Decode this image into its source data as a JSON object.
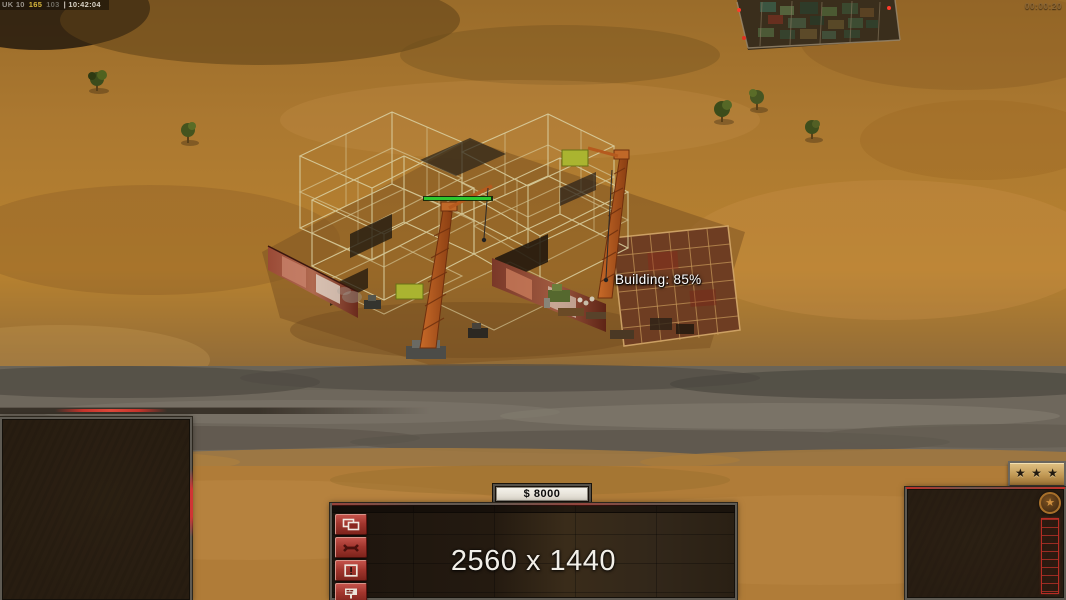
{
  "hud": {
    "debug_overlay": {
      "segments": [
        {
          "text": "UK 10",
          "color": "#9a948c"
        },
        {
          "text": "165",
          "color": "#d8b83c"
        },
        {
          "text": "103",
          "color": "#6e6a60"
        },
        {
          "text": "| 10:42:04",
          "color": "#d8d2c6"
        }
      ]
    },
    "match_timer": "00:00:20",
    "building_progress_label": "Building: 85%",
    "money_display": "$ 8000",
    "resolution_watermark": "2560 x 1440"
  },
  "command_panel": {
    "side_buttons": [
      {
        "icon": "windows-stack-icon"
      },
      {
        "icon": "wrench-icon"
      },
      {
        "icon": "alert-icon"
      },
      {
        "icon": "sell-icon"
      }
    ],
    "accent_color": "#c03028"
  },
  "rank_panel": {
    "tab_stars": "★ ★ ★",
    "emblem_glyph": "★"
  }
}
